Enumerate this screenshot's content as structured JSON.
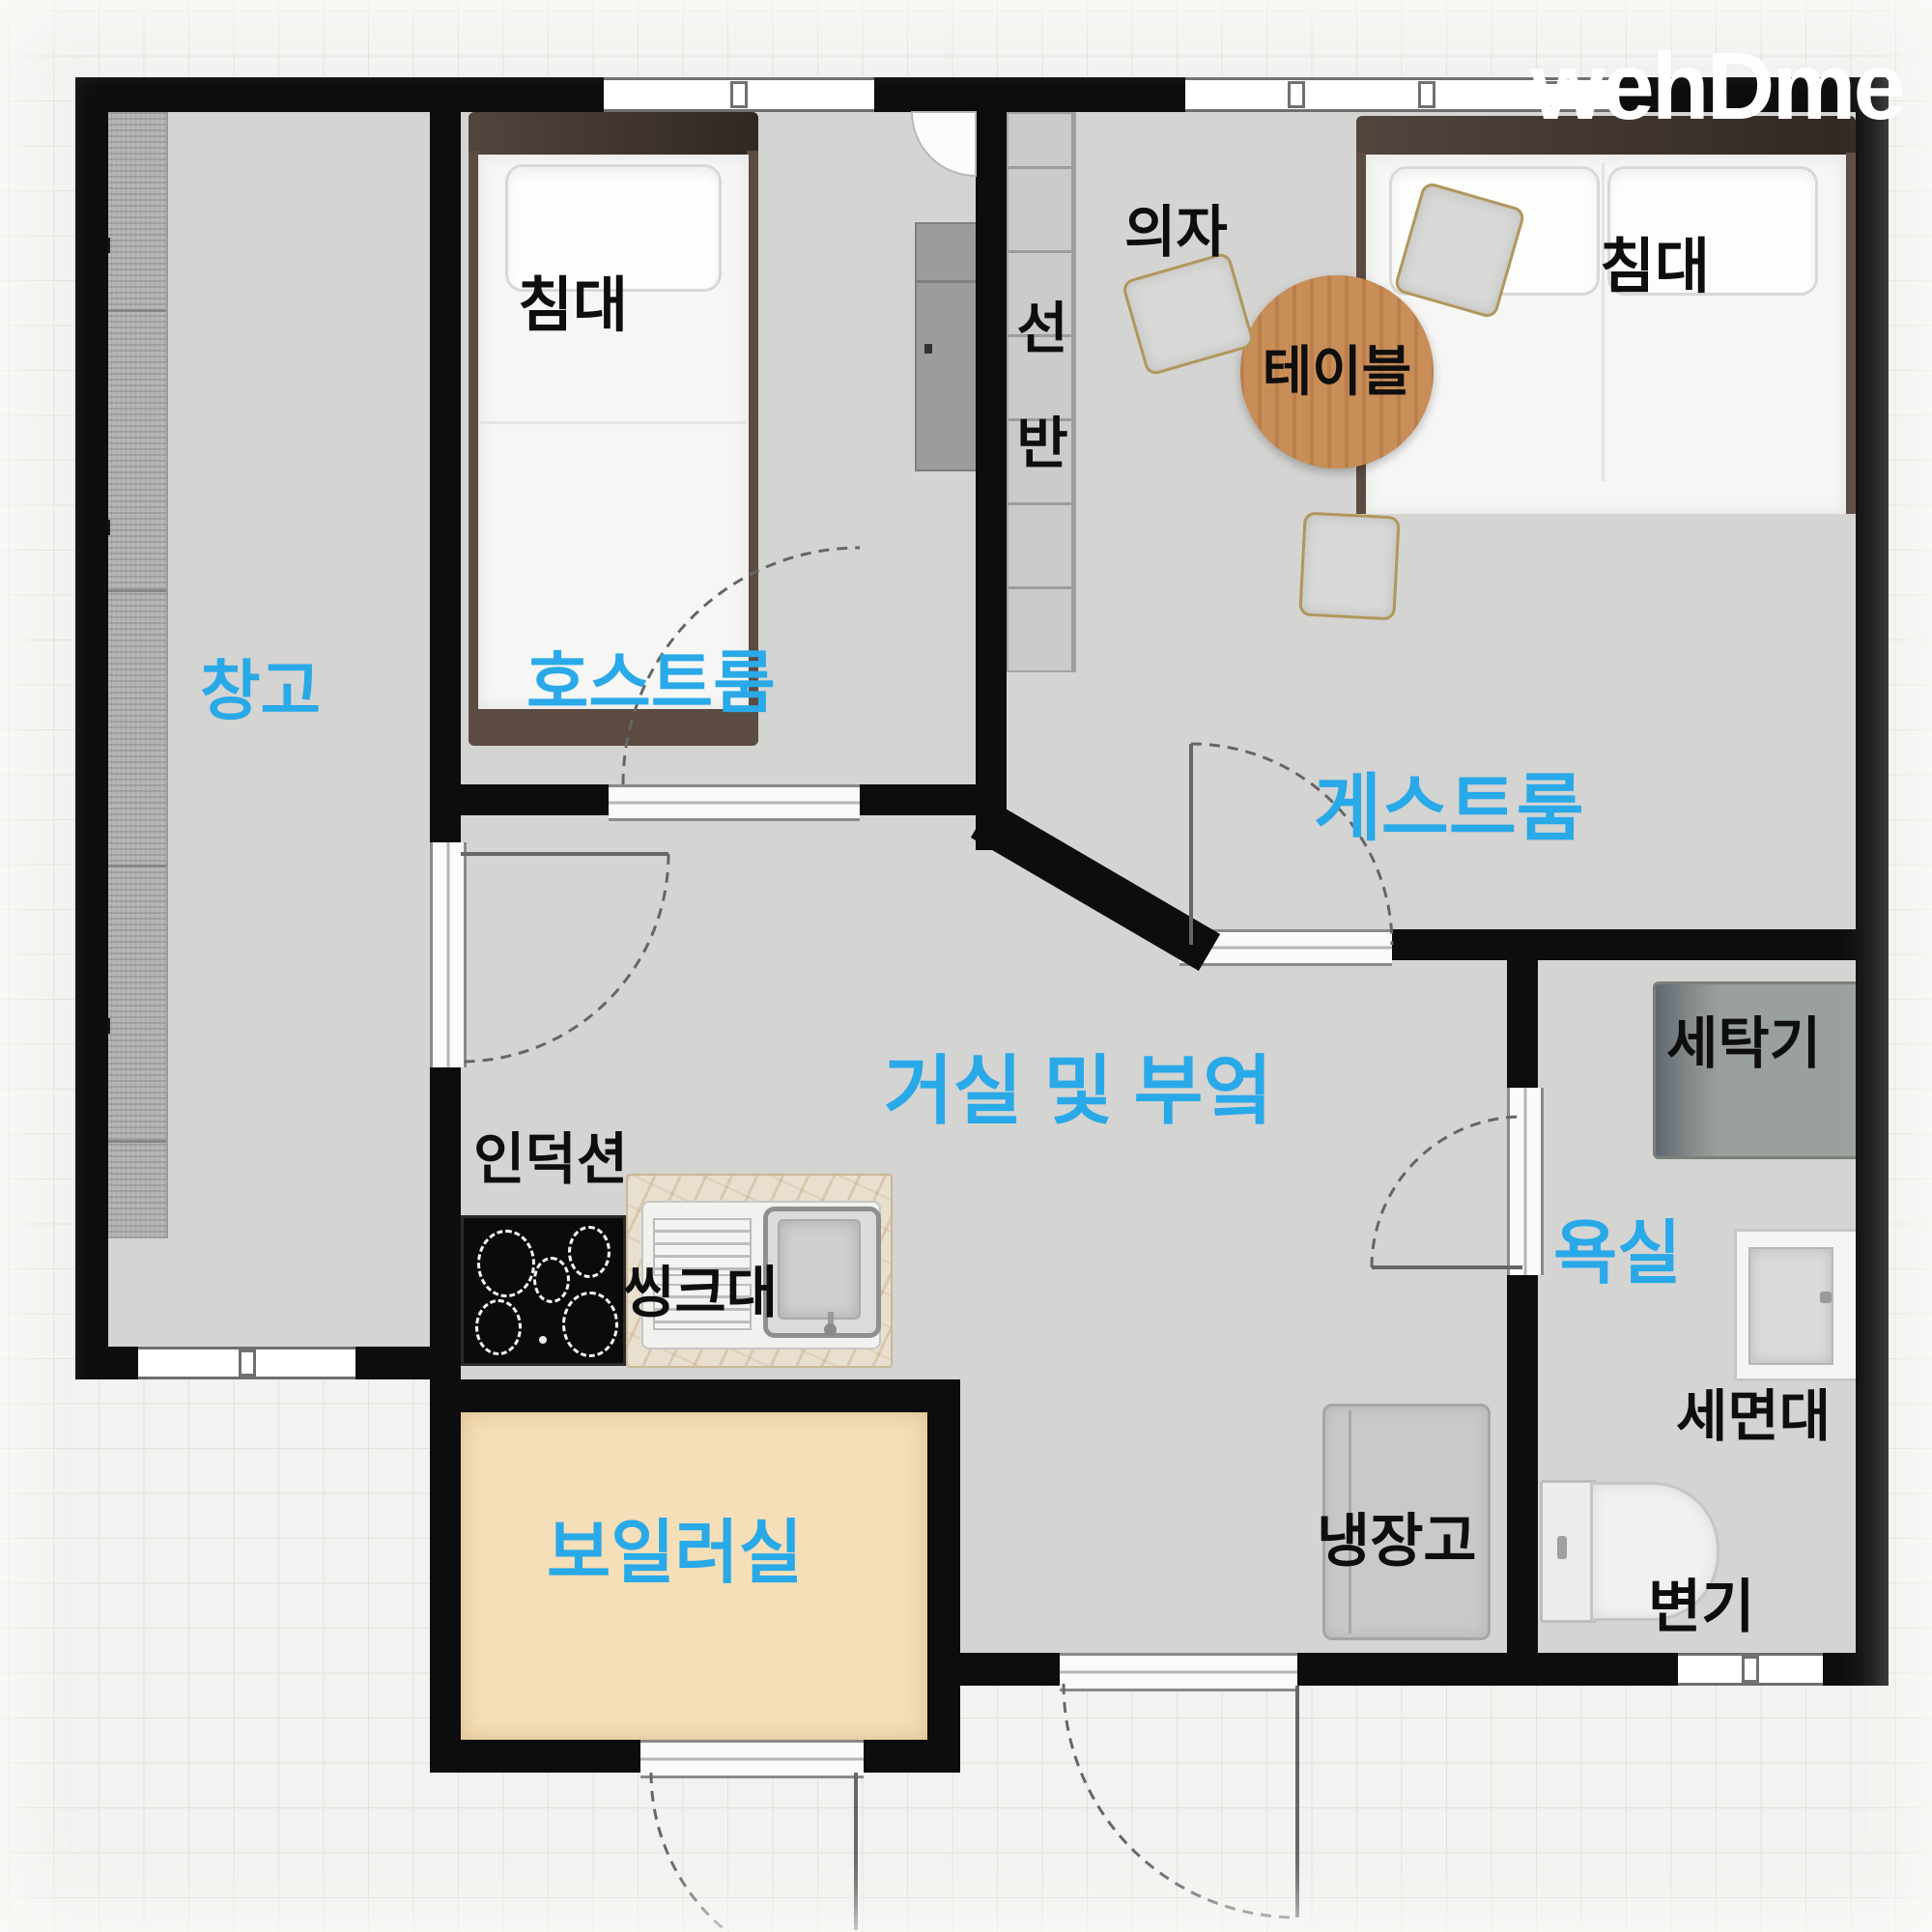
{
  "logo": {
    "text": "wehDme"
  },
  "colors": {
    "accent_blue": "#29a9e8",
    "wall": "#0d0d0d",
    "floor_gray": "#d4d4d2",
    "boiler_floor": "#f5dfb8",
    "table_wood": "#c98d57",
    "label_black": "#0e0e0e",
    "logo_white": "#ffffff"
  },
  "rooms": {
    "storage": {
      "label": "창고"
    },
    "host": {
      "label": "호스트룸"
    },
    "guest": {
      "label": "게스트룸"
    },
    "living_kitchen": {
      "label": "거실 및 부엌"
    },
    "bathroom": {
      "label": "욕실"
    },
    "boiler": {
      "label": "보일러실"
    }
  },
  "furniture": {
    "bed_host": {
      "label": "침대"
    },
    "bed_guest": {
      "label": "침대"
    },
    "chair": {
      "label": "의자"
    },
    "table": {
      "label": "테이블"
    },
    "shelf": {
      "label": "선반"
    },
    "induction": {
      "label": "인덕션"
    },
    "sink": {
      "label": "씽크대"
    },
    "fridge": {
      "label": "냉장고"
    },
    "washer": {
      "label": "세탁기"
    },
    "basin": {
      "label": "세면대"
    },
    "toilet": {
      "label": "변기"
    }
  }
}
